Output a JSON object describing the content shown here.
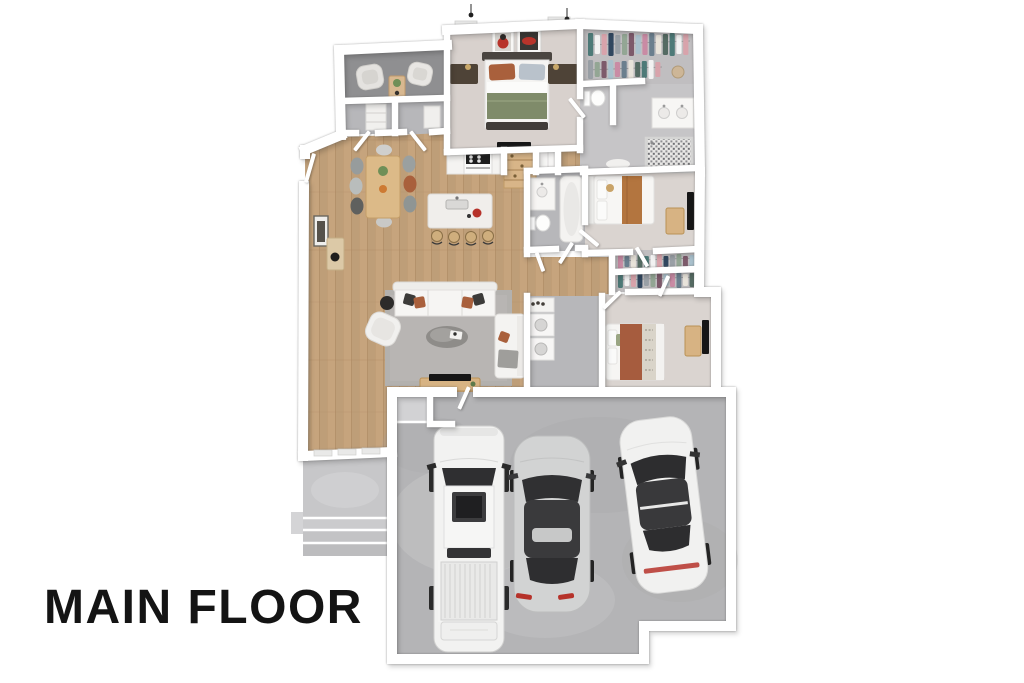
{
  "title": {
    "label": "MAIN FLOOR"
  },
  "scene": {
    "type": "3d-floor-plan-top-down-render",
    "rooms": [
      {
        "name": "office-den",
        "furniture": [
          "armchair",
          "armchair",
          "side-table",
          "shelf-unit"
        ]
      },
      {
        "name": "hall-closets",
        "furniture": [
          "shelving",
          "storage"
        ]
      },
      {
        "name": "entry",
        "furniture": [
          "console-table",
          "wall-art",
          "front-door"
        ]
      },
      {
        "name": "master-bedroom",
        "furniture": [
          "king-bed",
          "nightstand",
          "nightstand",
          "wall-art",
          "wall-art",
          "wall-tv",
          "pendant-light",
          "pendant-light",
          "window",
          "window"
        ]
      },
      {
        "name": "walk-in-closet",
        "furniture": [
          "clothes-rack",
          "clothes-rack",
          "basket"
        ]
      },
      {
        "name": "master-bathroom",
        "furniture": [
          "toilet",
          "double-vanity",
          "walk-in-shower",
          "bath-mat"
        ]
      },
      {
        "name": "kitchen",
        "furniture": [
          "range",
          "counter",
          "pantry-shelves",
          "refrigerator",
          "island-with-sink",
          "bar-stool",
          "bar-stool",
          "bar-stool",
          "bar-stool"
        ]
      },
      {
        "name": "dining-area",
        "furniture": [
          "dining-table",
          "chair",
          "chair",
          "chair",
          "chair",
          "chair",
          "chair",
          "chair",
          "chair",
          "plant-centerpiece",
          "fruit-bowl"
        ]
      },
      {
        "name": "living-room",
        "furniture": [
          "sectional-sofa",
          "chaise-loveseat",
          "armchair",
          "coffee-table",
          "area-rug",
          "media-console",
          "tv",
          "round-side-table",
          "throw-pillows"
        ]
      },
      {
        "name": "hall-bathroom",
        "furniture": [
          "vanity",
          "toilet",
          "bathtub"
        ]
      },
      {
        "name": "laundry-room",
        "furniture": [
          "counter",
          "washer",
          "dryer",
          "detergent-bottles"
        ]
      },
      {
        "name": "hallway",
        "furniture": [
          "open-doors"
        ]
      },
      {
        "name": "bedroom-2",
        "furniture": [
          "bed",
          "dresser",
          "wall-tv"
        ]
      },
      {
        "name": "bedroom-2-closet",
        "furniture": [
          "clothes-rack",
          "clothes-rack"
        ]
      },
      {
        "name": "bedroom-3",
        "furniture": [
          "bed",
          "dresser",
          "wall-tv"
        ]
      },
      {
        "name": "garage",
        "vehicles": [
          "white-pickup-truck",
          "silver-sedan",
          "white-sedan"
        ],
        "furniture": [
          "entry-step"
        ]
      },
      {
        "name": "front-porch",
        "furniture": [
          "steps",
          "stoop"
        ]
      }
    ]
  },
  "colors": {
    "bg": "#ffffff",
    "ink": "#141414",
    "wall": "#ffffff",
    "wood": "#c6a47d",
    "woodSeam": "#ab8760",
    "carpetMaster": "#d8d1cd",
    "carpetBed": "#dad4d0",
    "tile": "#b7b7ba",
    "tileLight": "#c6c5c7",
    "officeFloor": "#8f8f91",
    "closetFloor": "#c0bec0",
    "garage": "#b4b4b6",
    "porch": "#c7c7c9",
    "rug": "#b3b1ae",
    "whiteFurn": "#f4f3f1",
    "tan": "#d7b383",
    "walnut": "#4e4337",
    "sage": "#7f8b6a",
    "rust": "#a9603c",
    "camel": "#b3753f",
    "charcoal": "#3c3b39",
    "black": "#161616",
    "silverCar": "#d2d3d3",
    "glass": "#303032",
    "red": "#b6322a",
    "marble": "#f0eeeb"
  },
  "closet_palette": [
    "#4e7a78",
    "#f2f2f2",
    "#d8a3ab",
    "#31475f",
    "#9aa0a6",
    "#93a694",
    "#7d5a6b",
    "#a9c0cc",
    "#c98ba4",
    "#6b7f8e",
    "#e8e3da",
    "#556b63"
  ]
}
